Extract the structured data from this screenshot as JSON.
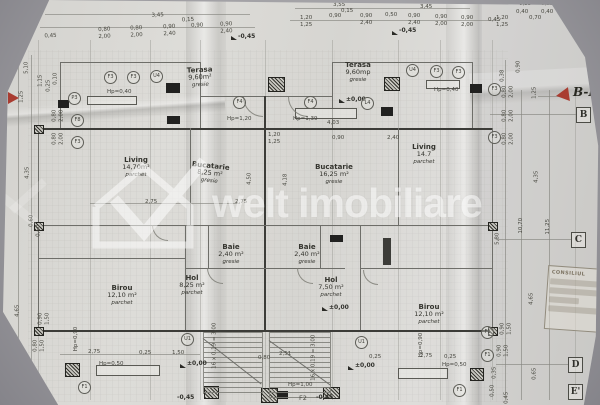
{
  "watermark": {
    "brand": "welt imobiliare"
  },
  "rooms": [
    {
      "name": "Terasa",
      "area": "9,60m²",
      "floor": "gresie"
    },
    {
      "name": "Living",
      "area": "14,70m²",
      "floor": "parchet"
    },
    {
      "name": "Bucatarie",
      "area": "8,25 m²",
      "floor": "gresie"
    },
    {
      "name": "Baie",
      "area": "2,40 m²",
      "floor": "gresie"
    },
    {
      "name": "Hol",
      "area": "8,25 m²",
      "floor": "parchet"
    },
    {
      "name": "Birou",
      "area": "12,10 m²",
      "floor": "parchet"
    },
    {
      "name": "Terasa",
      "area": "9,60mp",
      "floor": "gresie"
    },
    {
      "name": "Bucatarie",
      "area": "16,25 m²",
      "floor": "gresie"
    },
    {
      "name": "Living",
      "area": "14.7",
      "floor": "parchet"
    },
    {
      "name": "Baie",
      "area": "2,40 m²",
      "floor": "gresie"
    },
    {
      "name": "Hol",
      "area": "7,50 m²",
      "floor": "parchet"
    },
    {
      "name": "Birou",
      "area": "12,10 m²",
      "floor": "parchet"
    }
  ],
  "levels": [
    "-0,45",
    "-0,45",
    "±0,00",
    "±0,00",
    "±0,00",
    "±0,00",
    "-0,45",
    "-0,45"
  ],
  "dims_top_left": [
    "3,45",
    "0,45",
    "0,80",
    "2,00",
    "0,80",
    "2,00",
    "0,90",
    "2,40",
    "0,15",
    "0,90",
    "0,90",
    "2,40"
  ],
  "dims_top_right": [
    "3,55",
    "3,45",
    "1,20",
    "1,25",
    "0,90",
    "0,15",
    "0,90",
    "2,40",
    "0,50",
    "0,90",
    "2,40",
    "0,90",
    "2,00",
    "0,90",
    "2,00",
    "0,45",
    "0,35",
    "0,35",
    "0,40",
    "0,40",
    "0,70",
    "1,20",
    "1,25"
  ],
  "dims_left": [
    "0,90",
    "5,10",
    "1,15",
    "0,25",
    "0,10",
    "1,25",
    "0,80",
    "2,00",
    "0,80",
    "2,00",
    "4,35",
    "0,60",
    "0,60",
    "4,65",
    "0,90",
    "1,50",
    "0,80",
    "1,50",
    "0,95",
    "0,85",
    "0,35"
  ],
  "dims_right": [
    "0,90",
    "0,38",
    "0,80",
    "2,00",
    "0,80",
    "2,00",
    "0,80",
    "2,00",
    "1,25",
    "4,35",
    "10,70",
    "11,25",
    "5,80",
    "4,65",
    "0,90",
    "1,50",
    "0,90",
    "1,50",
    "0,35",
    "0,50",
    "0,65",
    "0,45"
  ],
  "dims_bottom": [
    "2,75",
    "0,25",
    "1,50",
    "2,51",
    "0,80",
    "0,25",
    "2,75",
    "0,25"
  ],
  "dims_inner": [
    "4,03",
    "1,20",
    "1,25",
    "0,90",
    "2,40",
    "2,75",
    "2,75",
    "4,50",
    "4,18"
  ],
  "hp_labels": [
    "Hp=0,40",
    "Hp=0,40",
    "Hp=1,20",
    "Hp=1,39",
    "Hp=0,90",
    "Hp=0,90",
    "Hp=0,50",
    "Hp=0,50",
    "Hp=1,00"
  ],
  "stair_note": "16 x 0,19 = 3,00",
  "markers": [
    "F3",
    "F3",
    "U4",
    "F4",
    "F4",
    "L4",
    "U4",
    "F3",
    "F3",
    "P3",
    "F8",
    "F3",
    "F3",
    "F3",
    "F1",
    "F1",
    "F1",
    "F1",
    "U1",
    "U1"
  ],
  "f2_label": "F2",
  "grid_letters": [
    "B",
    "C",
    "D",
    "E'"
  ],
  "section_label": "B-B",
  "stamp": {
    "title": "CONSILIUL"
  }
}
